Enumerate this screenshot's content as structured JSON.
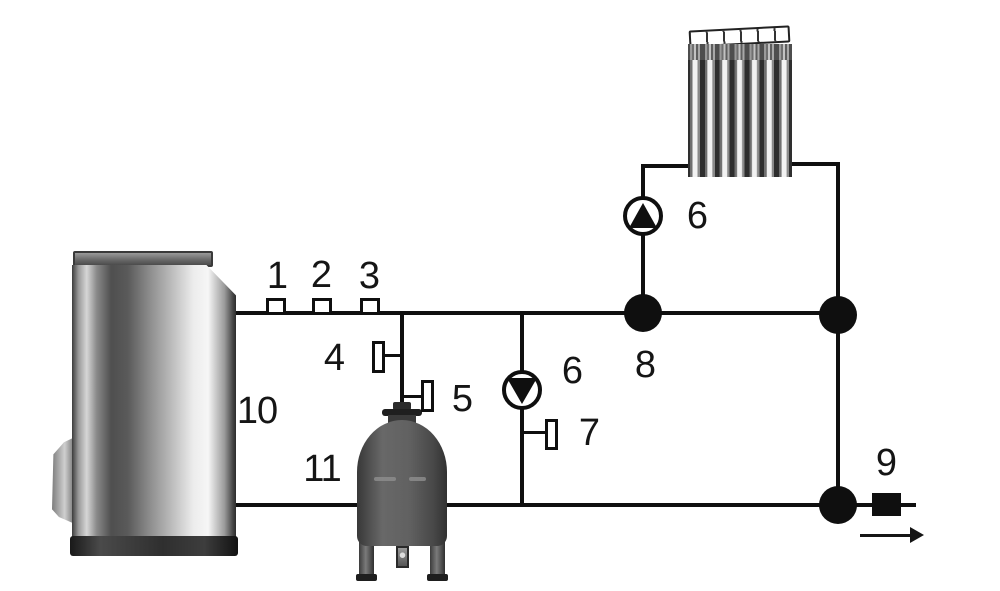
{
  "diagram": {
    "kind": "heating-system-piping-schematic",
    "background_color": "#ffffff",
    "line_color": "#0f0f0f",
    "tank_color": "#5c5c5c",
    "labels": {
      "sensor1": "1",
      "sensor2": "2",
      "sensor3": "3",
      "valve4": "4",
      "valve5": "5",
      "pump_radiator": "6",
      "pump_circuit": "6",
      "valve7": "7",
      "junction8": "8",
      "outlet9": "9",
      "boiler10": "10",
      "tank11": "11"
    }
  }
}
